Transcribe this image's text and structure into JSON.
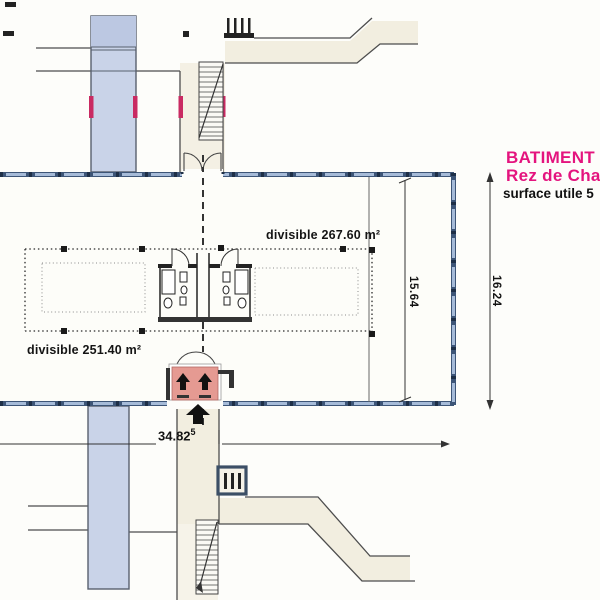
{
  "title_block": {
    "line1": "BATIMENT",
    "line2": "Rez de Cha",
    "line3": "surface utile 5"
  },
  "zones": {
    "right_label": "divisible 267.60 m²",
    "left_label": "divisible 251.40 m²"
  },
  "dimensions": {
    "overall_width": "34.82",
    "overall_width_sup": "5",
    "interior_depth": "15.64",
    "overall_depth": "16.24"
  },
  "colors": {
    "accent_magenta": "#e4147e",
    "wall_blue": "#3d5577",
    "window_blue": "#a6bbd8",
    "ramp_blue": "#c9d3e8",
    "fire_marker_pink": "#c92a62",
    "entrance_pink": "#e59a92",
    "walkway_beige": "#f2eee0"
  },
  "icons": {
    "up_arrow": "▲"
  }
}
